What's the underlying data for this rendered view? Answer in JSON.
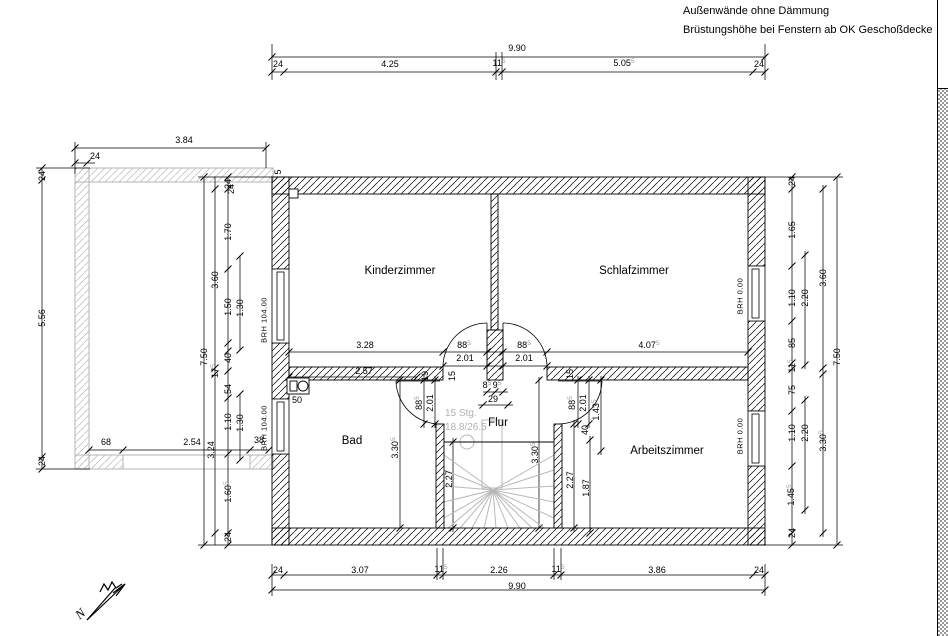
{
  "notes": {
    "line1": "Außenwände ohne Dämmung",
    "line2": "Brüstungshöhe bei Fenstern ab OK Geschoßdecke"
  },
  "north": {
    "letter": "N"
  },
  "stair": {
    "line1": "15 Stg.",
    "line2": "18.8/26.5"
  },
  "colors": {
    "wall": "#000000",
    "balcony": "#b5b5b5",
    "stair_gray": "#b8b8b8",
    "stair_text": "#b0b0b0",
    "dim_sup": "#9c9c9c"
  },
  "rooms": [
    {
      "name": "Kinderzimmer",
      "x": 400,
      "y": 271
    },
    {
      "name": "Schlafzimmer",
      "x": 634,
      "y": 271
    },
    {
      "name": "Bad",
      "x": 352,
      "y": 441
    },
    {
      "name": "Flur",
      "x": 498,
      "y": 423
    },
    {
      "name": "Arbeitszimmer",
      "x": 667,
      "y": 451
    }
  ],
  "window_labels": [
    {
      "t": "BRH 104.00",
      "x": 264,
      "y": 320
    },
    {
      "t": "BRH 104.00",
      "x": 264,
      "y": 428
    },
    {
      "t": "BRH 0.00",
      "x": 740,
      "y": 296
    },
    {
      "t": "BRH 0.00",
      "x": 740,
      "y": 436
    }
  ],
  "dims": [
    {
      "t": "9.90",
      "x": 517,
      "y": 48
    },
    {
      "t": "24",
      "x": 278,
      "y": 64
    },
    {
      "t": "4.25",
      "x": 390,
      "y": 64
    },
    {
      "t": "11",
      "sup": "5",
      "x": 499,
      "y": 63
    },
    {
      "t": "5.05",
      "sup": "5",
      "x": 624,
      "y": 63
    },
    {
      "t": "24",
      "x": 759,
      "y": 64
    },
    {
      "t": "3.84",
      "x": 184,
      "y": 140
    },
    {
      "t": "24",
      "x": 95,
      "y": 156
    },
    {
      "t": "24",
      "x": 231,
      "y": 189,
      "r": 1
    },
    {
      "t": "5",
      "x": 278,
      "y": 172,
      "r": 1
    },
    {
      "t": "24",
      "x": 42,
      "y": 176,
      "r": 1
    },
    {
      "t": "5.56",
      "x": 42,
      "y": 318,
      "r": 1
    },
    {
      "t": "24",
      "x": 42,
      "y": 461,
      "r": 1
    },
    {
      "t": "68",
      "x": 106,
      "y": 442
    },
    {
      "t": "2.54",
      "x": 192,
      "y": 442
    },
    {
      "t": "38",
      "x": 259,
      "y": 440
    },
    {
      "t": "7.50",
      "x": 204,
      "y": 357,
      "r": 1
    },
    {
      "t": "3.60",
      "x": 215,
      "y": 280,
      "r": 1
    },
    {
      "t": "3.24",
      "x": 211,
      "y": 450,
      "r": 1
    },
    {
      "t": "24",
      "x": 228,
      "y": 184,
      "r": 1
    },
    {
      "t": "1.70",
      "x": 228,
      "y": 232,
      "r": 1
    },
    {
      "t": "1.50",
      "x": 228,
      "y": 307,
      "r": 1
    },
    {
      "t": "1.30",
      "x": 240,
      "y": 308,
      "r": 1
    },
    {
      "t": "17",
      "sup": "5",
      "x": 215,
      "y": 371,
      "r": 1
    },
    {
      "t": "40",
      "x": 228,
      "y": 358,
      "r": 1
    },
    {
      "t": "54",
      "x": 228,
      "y": 389,
      "r": 1
    },
    {
      "t": "1.10",
      "x": 228,
      "y": 422,
      "r": 1
    },
    {
      "t": "1.30",
      "x": 240,
      "y": 423,
      "r": 1
    },
    {
      "t": "1.60",
      "sup": "5",
      "x": 228,
      "y": 492,
      "r": 1
    },
    {
      "t": "24",
      "x": 228,
      "y": 537,
      "r": 1
    },
    {
      "t": "24",
      "x": 792,
      "y": 181,
      "r": 1
    },
    {
      "t": "1.65",
      "x": 792,
      "y": 230,
      "r": 1
    },
    {
      "t": "1.10",
      "x": 792,
      "y": 298,
      "r": 1
    },
    {
      "t": "2.20",
      "x": 805,
      "y": 298,
      "r": 1
    },
    {
      "t": "85",
      "x": 792,
      "y": 343,
      "r": 1
    },
    {
      "t": "11",
      "sup": "5",
      "x": 792,
      "y": 366,
      "r": 1
    },
    {
      "t": "75",
      "x": 792,
      "y": 390,
      "r": 1
    },
    {
      "t": "1.10",
      "x": 792,
      "y": 433,
      "r": 1
    },
    {
      "t": "2.20",
      "x": 805,
      "y": 433,
      "r": 1
    },
    {
      "t": "1.45",
      "sup": "5",
      "x": 791,
      "y": 495,
      "r": 1
    },
    {
      "t": "24",
      "x": 792,
      "y": 533,
      "r": 1
    },
    {
      "t": "3.60",
      "x": 823,
      "y": 278,
      "r": 1
    },
    {
      "t": "3.30",
      "sup": "5",
      "x": 823,
      "y": 441,
      "r": 1
    },
    {
      "t": "7.50",
      "x": 837,
      "y": 357,
      "r": 1
    },
    {
      "t": "24",
      "x": 278,
      "y": 570
    },
    {
      "t": "3.07",
      "x": 360,
      "y": 570
    },
    {
      "t": "11",
      "sup": "5",
      "x": 441,
      "y": 569
    },
    {
      "t": "2.26",
      "x": 499,
      "y": 570
    },
    {
      "t": "11",
      "sup": "5",
      "x": 558,
      "y": 569
    },
    {
      "t": "3.86",
      "x": 657,
      "y": 570
    },
    {
      "t": "24",
      "x": 759,
      "y": 570
    },
    {
      "t": "9.90",
      "x": 517,
      "y": 586
    },
    {
      "t": "3.28",
      "x": 365,
      "y": 345
    },
    {
      "t": "88",
      "sup": "5",
      "x": 464,
      "y": 345
    },
    {
      "t": "2.01",
      "x": 465,
      "y": 358
    },
    {
      "t": "88",
      "sup": "5",
      "x": 524,
      "y": 345
    },
    {
      "t": "2.01",
      "x": 524,
      "y": 358
    },
    {
      "t": "4.07",
      "sup": "5",
      "x": 649,
      "y": 345
    },
    {
      "t": "2.57",
      "x": 364,
      "y": 371
    },
    {
      "t": "19",
      "x": 425,
      "y": 376,
      "r": 1
    },
    {
      "t": "15",
      "x": 452,
      "y": 376,
      "r": 1
    },
    {
      "t": "8",
      "sup": "5",
      "x": 487,
      "y": 385
    },
    {
      "t": "9",
      "sup": "5",
      "x": 497,
      "y": 385
    },
    {
      "t": "29",
      "x": 493,
      "y": 399
    },
    {
      "t": "88",
      "sup": "5",
      "x": 419,
      "y": 403,
      "r": 1
    },
    {
      "t": "2.01",
      "x": 430,
      "y": 403,
      "r": 1
    },
    {
      "t": "3.30",
      "sup": "5",
      "x": 395,
      "y": 448,
      "r": 1
    },
    {
      "t": "50",
      "x": 297,
      "y": 400
    },
    {
      "t": "2.27",
      "x": 449,
      "y": 479,
      "r": 1
    },
    {
      "t": "3.30",
      "sup": "5",
      "x": 535,
      "y": 453,
      "r": 1
    },
    {
      "t": "88",
      "sup": "5",
      "x": 572,
      "y": 403,
      "r": 1
    },
    {
      "t": "2.01",
      "x": 583,
      "y": 403,
      "r": 1
    },
    {
      "t": "1.43",
      "sup": "5",
      "x": 596,
      "y": 410,
      "r": 1
    },
    {
      "t": "40",
      "x": 585,
      "y": 430,
      "r": 1
    },
    {
      "t": "15",
      "x": 570,
      "y": 374,
      "r": 1
    },
    {
      "t": "2.27",
      "x": 570,
      "y": 480,
      "r": 1
    },
    {
      "t": "1.87",
      "x": 586,
      "y": 488,
      "r": 1
    }
  ]
}
